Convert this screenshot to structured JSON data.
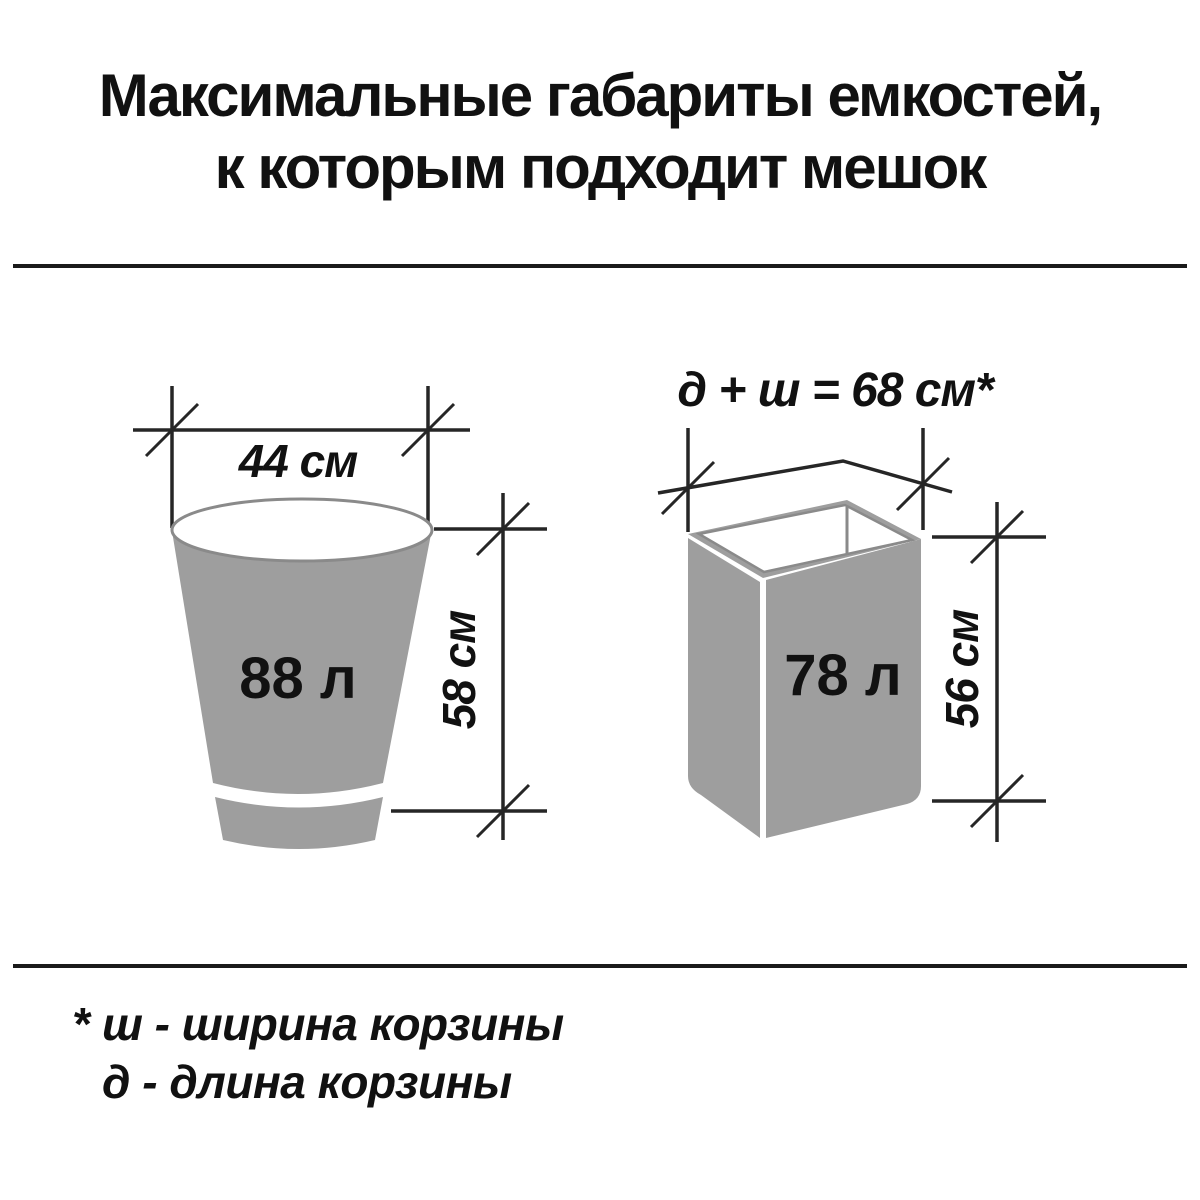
{
  "title": {
    "line1": "Максимальные габариты емкостей,",
    "line2": "к которым подходит мешок"
  },
  "left_container": {
    "shape": "round-tapered-bucket",
    "volume_label": "88 л",
    "top_width_label": "44 см",
    "height_label": "58 см"
  },
  "right_container": {
    "shape": "rectangular-basket",
    "perimeter_label": "д + ш = 68 см*",
    "volume_label": "78 л",
    "height_label": "56 см"
  },
  "footnote": {
    "marker": "*",
    "line1": "ш - ширина корзины",
    "line2": "д  - длина корзины"
  },
  "colors": {
    "container_fill": "#9e9e9e",
    "container_outline": "#8a8a8a",
    "dimension_line": "#262626",
    "text": "#111111",
    "background": "#ffffff"
  }
}
